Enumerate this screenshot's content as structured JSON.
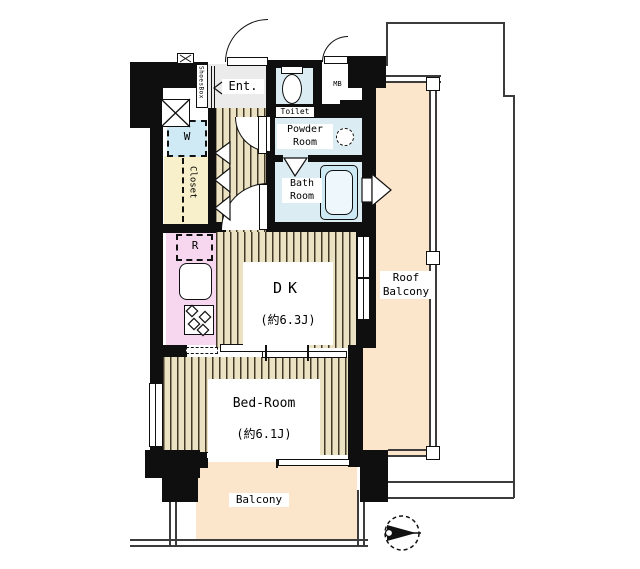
{
  "plan": {
    "rooms": {
      "ent": {
        "label": "Ent."
      },
      "shoes_box": {
        "label": "ShoesBox"
      },
      "toilet": {
        "label": "Toilet"
      },
      "mb": {
        "label": "MB"
      },
      "powder_room": {
        "label": "Powder Room"
      },
      "bath_room": {
        "label": "Bath Room"
      },
      "washer": {
        "label": "W"
      },
      "closet": {
        "label": "Closet"
      },
      "fridge": {
        "label": "R"
      },
      "dk": {
        "label": "DK",
        "size": "(約6.3J)"
      },
      "bedroom": {
        "label": "Bed-Room",
        "size": "(約6.1J)"
      },
      "balcony": {
        "label": "Balcony"
      },
      "roof_balcony": {
        "label": "Roof Balcony"
      }
    },
    "icons": {
      "north_arrow": "compass-north-arrow",
      "shaft": "x-box-shaft",
      "stove": "gas-stove-burners",
      "vent": "bath-vent-fan"
    },
    "colors": {
      "wall": "#0f0f0f",
      "wood_floor": "#ebe2c3",
      "wood_stripe": "#423a27",
      "wet_room": "#dbedf3",
      "bathtub": "#cde9f3",
      "kitchen": "#f6d7ef",
      "closet": "#f7f0ca",
      "balcony": "#fbe5cb",
      "entrance": "#ebebeb"
    }
  }
}
